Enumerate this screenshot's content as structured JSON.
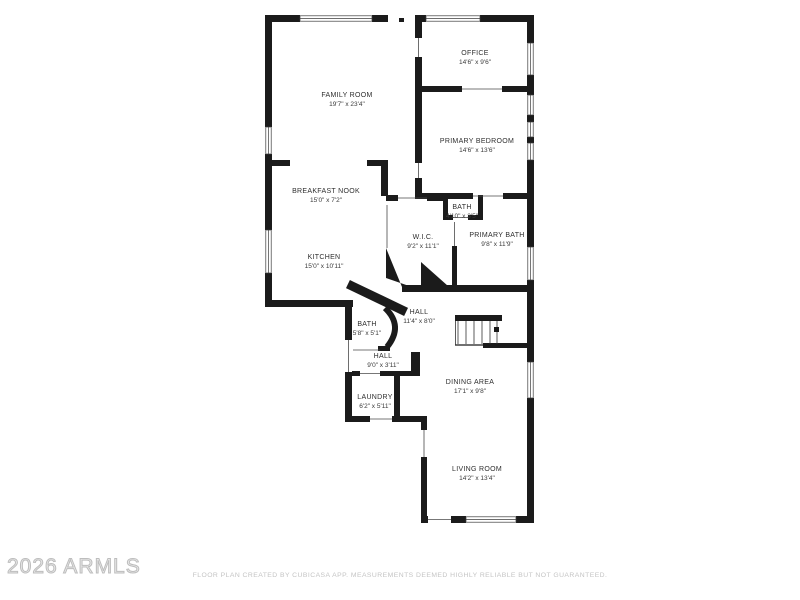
{
  "page": {
    "background": "#ffffff"
  },
  "watermark": {
    "text": "2026 ARMLS",
    "color": "#bdbdbd"
  },
  "disclaimer": {
    "text": "FLOOR PLAN CREATED BY CUBICASA APP. MEASUREMENTS DEEMED HIGHLY RELIABLE BUT NOT GUARANTEED.",
    "color": "#c4c4c4"
  },
  "floor_plan": {
    "wall_color": "#1b1b1b",
    "rooms": [
      {
        "name": "FAMILY ROOM",
        "dims": "19'7\" x 23'4\""
      },
      {
        "name": "OFFICE",
        "dims": "14'6\" x 9'6\""
      },
      {
        "name": "PRIMARY BEDROOM",
        "dims": "14'6\" x 13'6\""
      },
      {
        "name": "BREAKFAST NOOK",
        "dims": "15'0\" x 7'2\""
      },
      {
        "name": "BATH",
        "dims": "4'10\" x 3'5\""
      },
      {
        "name": "W.I.C.",
        "dims": "9'2\" x 11'1\""
      },
      {
        "name": "PRIMARY BATH",
        "dims": "9'8\" x 11'9\""
      },
      {
        "name": "KITCHEN",
        "dims": "15'0\" x 10'11\""
      },
      {
        "name": "HALL",
        "dims": "11'4\" x 8'0\""
      },
      {
        "name": "BATH",
        "dims": "5'8\" x 5'1\""
      },
      {
        "name": "HALL",
        "dims": "9'0\" x 3'11\""
      },
      {
        "name": "LAUNDRY",
        "dims": "6'2\" x 5'11\""
      },
      {
        "name": "DINING AREA",
        "dims": "17'1\" x 9'8\""
      },
      {
        "name": "LIVING ROOM",
        "dims": "14'2\" x 13'4\""
      }
    ]
  }
}
